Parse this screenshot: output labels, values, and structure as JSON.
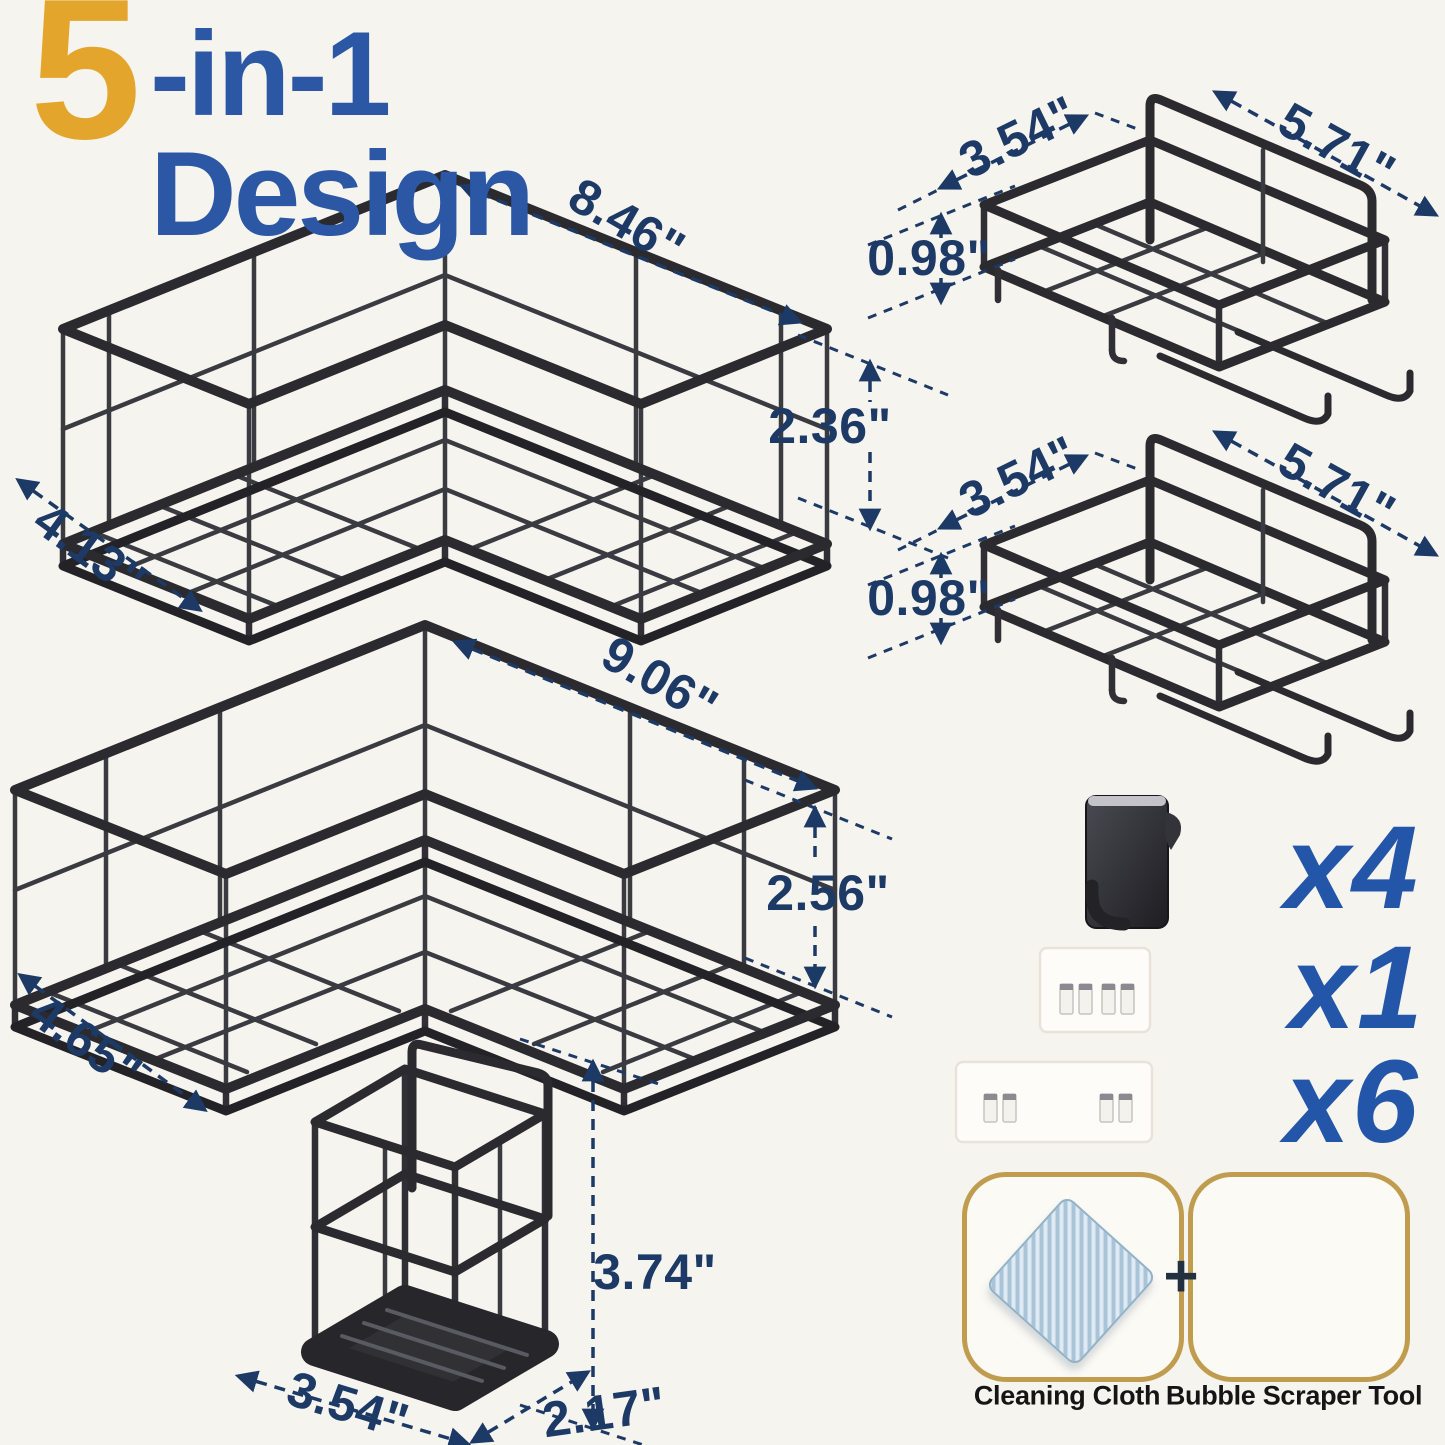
{
  "title": {
    "prefix": "5",
    "rest": "-in-1 Design"
  },
  "shelf_small": {
    "length": "8.46\"",
    "height": "2.36\"",
    "depth": "4.13\""
  },
  "shelf_large": {
    "length": "9.06\"",
    "height": "2.56\"",
    "depth": "4.65\""
  },
  "basket_top": {
    "depth": "3.54\"",
    "length": "5.71\"",
    "height": "0.98\""
  },
  "basket_mid": {
    "depth": "3.54\"",
    "length": "5.71\"",
    "height": "0.98\""
  },
  "holder": {
    "height": "3.74\"",
    "width": "3.54\"",
    "depth": "2.17\""
  },
  "kit": {
    "hook_count": "x4",
    "strip_small_count": "x1",
    "strip_large_count": "x6",
    "plus_sign": "+",
    "cloth_label": "Cleaning Cloth",
    "scraper_label": "Bubble Scraper Tool"
  },
  "colors": {
    "accent_gold": "#E3A52C",
    "accent_blue": "#2B57A5",
    "dimension_navy": "#1D3A66",
    "count_blue": "#2356A8",
    "wire_black": "#2A2A2F",
    "scraper_yellow": "#F3B428",
    "kit_box_border": "#C09C4F",
    "cloth_blue": "#A9C4D8"
  }
}
